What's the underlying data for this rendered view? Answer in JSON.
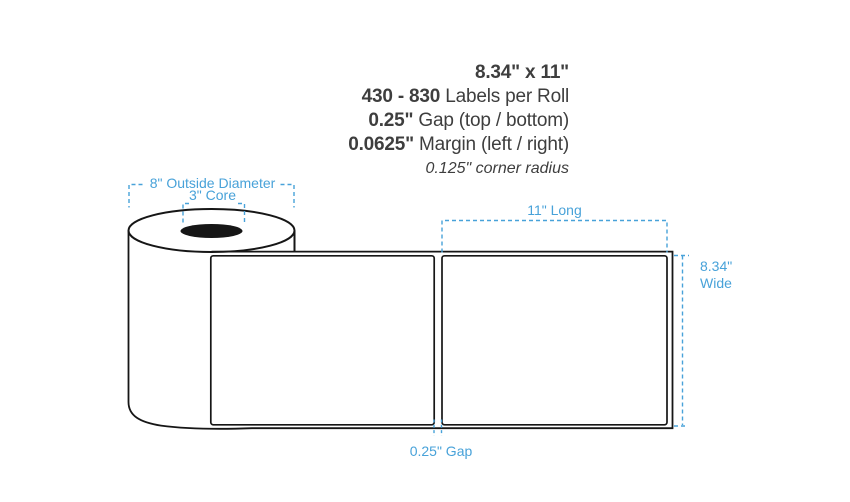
{
  "colors": {
    "accent": "#48a2d9",
    "ink": "#161616",
    "text": "#3e3e3e"
  },
  "specs": {
    "size": {
      "bold": "8.34\" x 11\"",
      "rest": ""
    },
    "count": {
      "bold": "430 - 830",
      "rest": " Labels per Roll"
    },
    "gap": {
      "bold": "0.25\"",
      "rest": " Gap (top / bottom)"
    },
    "margin": {
      "bold": "0.0625\"",
      "rest": " Margin (left / right)"
    },
    "corner_radius": "0.125\" corner radius"
  },
  "diagram": {
    "outside_diameter_label": "8\" Outside Diameter",
    "core_label": "3\" Core",
    "length_label": "11\" Long",
    "width_value": "8.34\"",
    "width_word": "Wide",
    "gap_label": "0.25\" Gap"
  }
}
